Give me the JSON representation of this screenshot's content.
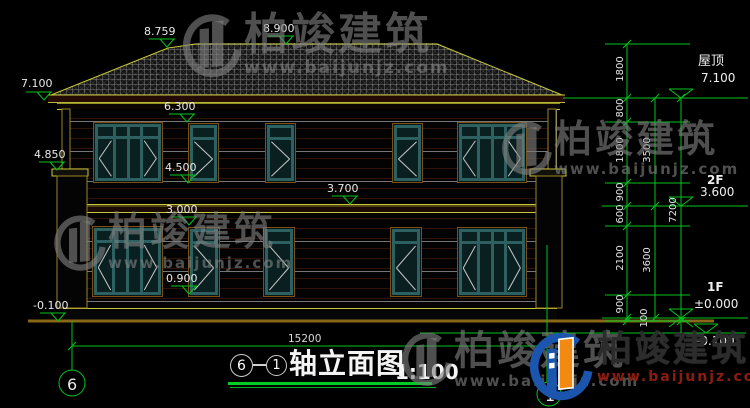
{
  "brand": {
    "name": "柏竣建筑",
    "url": "www.baijunjz.com"
  },
  "title": {
    "left_axis": "6",
    "right_axis": "1",
    "text": "轴立面图",
    "scale": "1:100"
  },
  "overall_width": "15200",
  "spot": {
    "ridge_left": "8.759",
    "ridge": "8.900",
    "eave": "7.100",
    "pillar_cap": "4.850",
    "f2_win_top": "6.300",
    "f2_win_sill": "4.500",
    "floor_band": "3.700",
    "f1_win_top": "3.000",
    "f1_win_sill": "0.900",
    "ground": "-0.100"
  },
  "chains": {
    "inner": [
      "1800",
      "800",
      "1800",
      "900",
      "600",
      "2100",
      "900",
      "100"
    ],
    "mid": [
      "3500",
      "3600"
    ],
    "outer": [
      "7200"
    ]
  },
  "floors": {
    "roof_name": "屋顶",
    "roof_level": "7.100",
    "f2_name": "2F",
    "f2_level": "3.600",
    "f1_name": "1F",
    "f1_level": "±0.000",
    "ground_level": "-0.100"
  }
}
